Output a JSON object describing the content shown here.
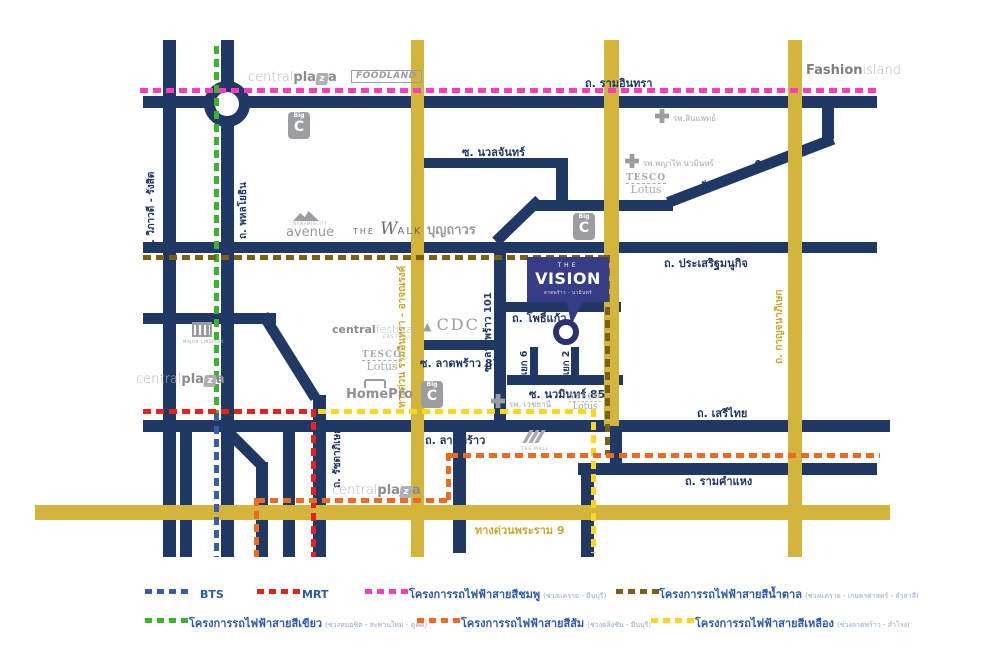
{
  "colors": {
    "navy_road": "#203864",
    "yellow_road": "#d2b53a",
    "bts": "#3a5da8",
    "mrt": "#e8201e",
    "pink": "#fc3cc1",
    "green": "#3bb42a",
    "brown": "#7b5f17",
    "orange": "#ef6b21",
    "yellow_line": "#ffd61f",
    "vision_box": "#363c85",
    "label_navy": "#1f3765",
    "label_yellow": "#c9a82d",
    "logo_gray": "#a7a9ac"
  },
  "project": {
    "the": "THE",
    "name": "VISION",
    "subtitle": "ลาดพร้าว - นวมินทร์"
  },
  "roads": {
    "ram_inthra": "ถ. รามอินทรา",
    "vibhavadi": "ถ. วิภาวดี - รังสิต",
    "phahonyothin": "ถ. พหลโยธิน",
    "nuanchan": "ซ. นวลจันทร์",
    "ratchada_ramindra": "ถ. รัชดา - รามอินทรา",
    "prasert_manukit": "ถ. ประเสริฐมนูกิจ",
    "pho_kaew": "ถ. โพธิ์แก้ว",
    "ladprao101": "ซ. ลาดพร้าว 101",
    "ladprao87": "ซ. ลาดพร้าว 87",
    "yaek6": "แยก 6",
    "yaek2": "แยก 2",
    "nawamin85": "ซ. นวมินทร์ 85",
    "seri_thai": "ถ. เสรีไทย",
    "ladprao": "ถ. ลาดพร้าว",
    "ramkhamhaeng": "ถ. รามคำแหง",
    "ratchadaphisek": "ถ. รัชดาภิเษก",
    "rama9_expressway": "ทางด่วนพระราม 9",
    "ramindra_expressway": "ทางด่วน รามอินทรา - อาจณรงค์",
    "kanchanaphisek": "ถ. กาญจนาภิเษก"
  },
  "landmarks": {
    "central_plaza": {
      "p1": "central",
      "p2": "pla",
      "p3": "z",
      "p4": "a"
    },
    "foodland": "FOODLAND",
    "fashion_island": {
      "p1": "Fashion",
      "p2": "island"
    },
    "big_c": {
      "small": "Big",
      "big": "C"
    },
    "tesco": {
      "l1": "TESCO",
      "l2": "Lotus"
    },
    "hospitals": {
      "sinphaet": "รพ.สินแพทย์",
      "phyathai": "รพ.พญาไท นวมินทร์",
      "vejthani": "รพ. เวชธานี"
    },
    "nawamin_city": {
      "top": "NAWAMINCITY",
      "main": "avenue"
    },
    "the_walk": {
      "p1": "THE",
      "p2": "W",
      "p3": "ALK"
    },
    "boonthavorn": "บุญถาวร",
    "major_cineplex": "MAJOR CINEPLEX",
    "central_festival": {
      "p1": "central",
      "p2": "festival",
      "sub": "EASTVILLE"
    },
    "cdc": {
      "icon": "▲",
      "text": "CDC"
    },
    "homepro": "HomePro",
    "the_mall": "THE MALL"
  },
  "legend": {
    "items": [
      {
        "key": "bts",
        "label": "BTS",
        "sub": "",
        "color": "#3a5da8"
      },
      {
        "key": "mrt",
        "label": "MRT",
        "sub": "",
        "color": "#e8201e"
      },
      {
        "key": "pink",
        "label": "โครงการรถไฟฟ้าสายสีชมพู",
        "sub": "(ช่วงแคราย - มีนบุรี)",
        "color": "#fc3cc1"
      },
      {
        "key": "brown",
        "label": "โครงการรถไฟฟ้าสายสีน้ำตาล",
        "sub": "(ช่วงแคราย - เกษตรศาสตร์ - ลำสาลี)",
        "color": "#7b5f17"
      },
      {
        "key": "green",
        "label": "โครงการรถไฟฟ้าสายสีเขียว",
        "sub": "(ช่วงหมอชิต - สะพานใหม่ - คูคต)",
        "color": "#3bb42a"
      },
      {
        "key": "orange",
        "label": "โครงการรถไฟฟ้าสายสีส้ม",
        "sub": "(ช่วงตลิ่งชัน - มีนบุรี)",
        "color": "#ef6b21"
      },
      {
        "key": "yellow",
        "label": "โครงการรถไฟฟ้าสายสีเหลือง",
        "sub": "(ช่วงลาดพร้าว - สำโรง)",
        "color": "#ffd61f"
      }
    ]
  }
}
